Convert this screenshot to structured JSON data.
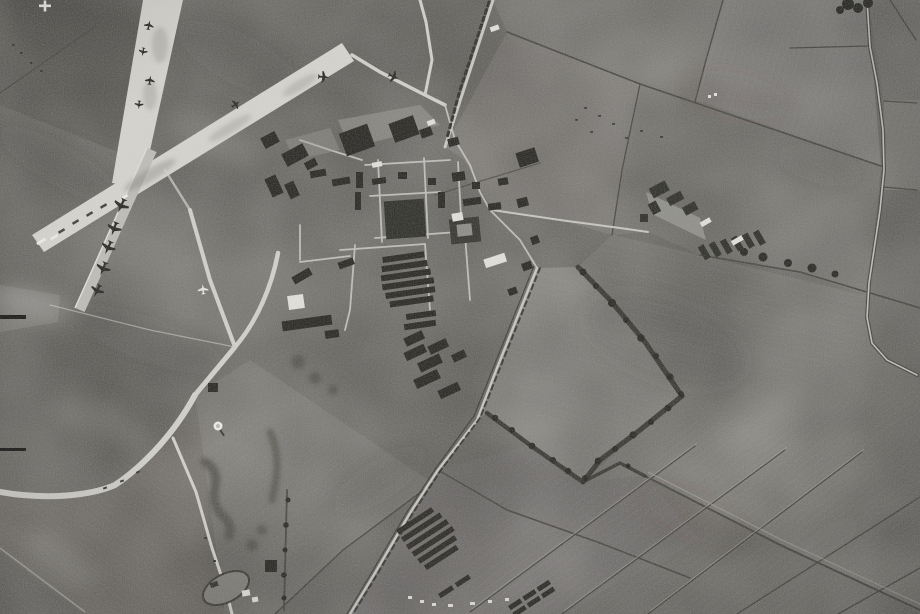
{
  "scene": {
    "description": "Black-and-white vertical aerial reconnaissance photograph of a military airfield with crossed runways, parked aircraft, a technical site of buildings, a curving perimeter track and surrounding hedged farm fields",
    "features": [
      "runways",
      "parked-aircraft",
      "technical-site",
      "barracks-rows",
      "perimeter-track",
      "farm-fields",
      "hedgerows",
      "roads",
      "fiducial-marks"
    ]
  },
  "palette": {
    "base": "#716f69",
    "grass_dark": "#5b5954",
    "field_light": "#8a8882",
    "runway": "#d7d6d0",
    "taxiway": "#bebdb7",
    "road": "#c9c8c2",
    "track": "#d3d2cc",
    "hedge": "#2e2d28",
    "boundary": "#45443f",
    "building_dark": "#23221d",
    "building_light": "#e4e3dd",
    "white_mark": "#f1f0ec",
    "black_mark": "#121210"
  }
}
